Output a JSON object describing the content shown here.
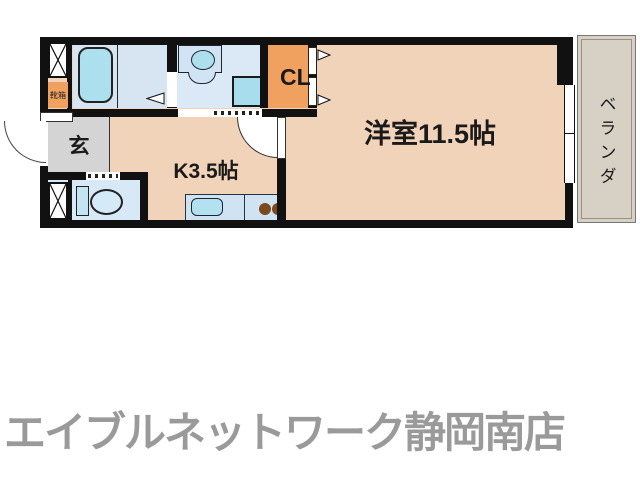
{
  "floor_plan": {
    "labels": {
      "living_room": "洋室11.5帖",
      "kitchen": "K3.5帖",
      "entrance": "玄",
      "closet": "CL",
      "veranda": "ベランダ",
      "shoe_box": "靴箱"
    },
    "colors": {
      "room_peach": "#f0d3b8",
      "closet_orange": "#f0a160",
      "wet_area_blue": "#d9e7f5",
      "fixture_cyan": "#aadff0",
      "entrance_gray": "#d4d4d4",
      "veranda_beige": "#d7d0c5",
      "wall_black": "#111111",
      "burner_brown": "#7a4a1e",
      "footer_gray": "#9a9a9a"
    }
  },
  "footer": {
    "brand": "エイブルネットワーク静岡南店"
  }
}
